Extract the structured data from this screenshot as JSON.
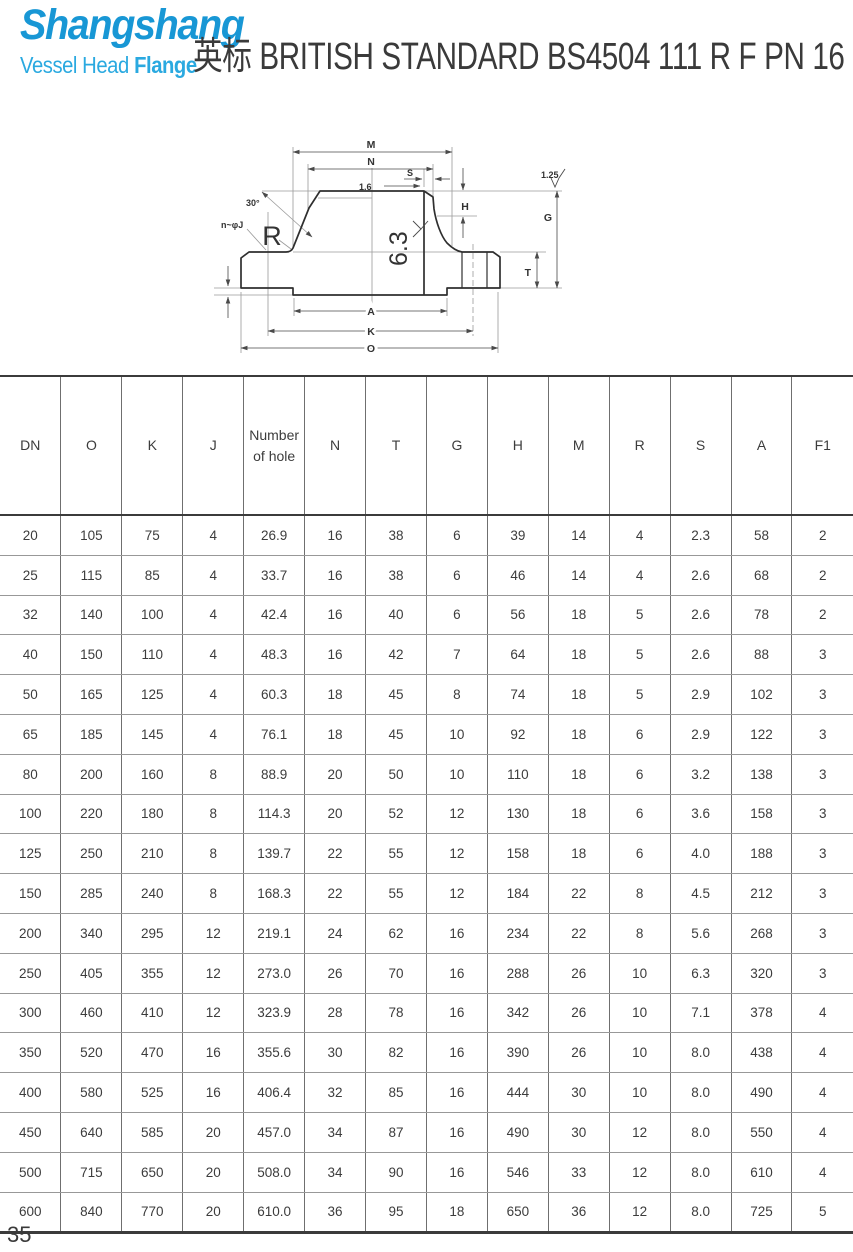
{
  "logo": {
    "brand": "Shangshang",
    "sub1": "Vessel Head",
    "sub2": "Flange",
    "brand_color": "#1897d5",
    "sub_color": "#2aa9e0"
  },
  "header": {
    "title": "英标 BRITISH STANDARD BS4504 111 R F PN 16"
  },
  "drawing": {
    "labels": {
      "m": "M",
      "n": "N",
      "s": "S",
      "chamfer": "1.6",
      "h": "H",
      "g": "G",
      "t": "T",
      "a": "A",
      "k": "K",
      "o": "O",
      "radius": "R",
      "angle": "30°",
      "holes": "n~φJ",
      "roughness_bore": "6.3",
      "roughness_face": "1.25"
    }
  },
  "table": {
    "columns": [
      "DN",
      "O",
      "K",
      "J",
      "Number of hole",
      "N",
      "T",
      "G",
      "H",
      "M",
      "R",
      "S",
      "A",
      "F1"
    ],
    "rows": [
      [
        "20",
        "105",
        "75",
        "4",
        "26.9",
        "16",
        "38",
        "6",
        "39",
        "14",
        "4",
        "2.3",
        "58",
        "2"
      ],
      [
        "25",
        "115",
        "85",
        "4",
        "33.7",
        "16",
        "38",
        "6",
        "46",
        "14",
        "4",
        "2.6",
        "68",
        "2"
      ],
      [
        "32",
        "140",
        "100",
        "4",
        "42.4",
        "16",
        "40",
        "6",
        "56",
        "18",
        "5",
        "2.6",
        "78",
        "2"
      ],
      [
        "40",
        "150",
        "110",
        "4",
        "48.3",
        "16",
        "42",
        "7",
        "64",
        "18",
        "5",
        "2.6",
        "88",
        "3"
      ],
      [
        "50",
        "165",
        "125",
        "4",
        "60.3",
        "18",
        "45",
        "8",
        "74",
        "18",
        "5",
        "2.9",
        "102",
        "3"
      ],
      [
        "65",
        "185",
        "145",
        "4",
        "76.1",
        "18",
        "45",
        "10",
        "92",
        "18",
        "6",
        "2.9",
        "122",
        "3"
      ],
      [
        "80",
        "200",
        "160",
        "8",
        "88.9",
        "20",
        "50",
        "10",
        "110",
        "18",
        "6",
        "3.2",
        "138",
        "3"
      ],
      [
        "100",
        "220",
        "180",
        "8",
        "114.3",
        "20",
        "52",
        "12",
        "130",
        "18",
        "6",
        "3.6",
        "158",
        "3"
      ],
      [
        "125",
        "250",
        "210",
        "8",
        "139.7",
        "22",
        "55",
        "12",
        "158",
        "18",
        "6",
        "4.0",
        "188",
        "3"
      ],
      [
        "150",
        "285",
        "240",
        "8",
        "168.3",
        "22",
        "55",
        "12",
        "184",
        "22",
        "8",
        "4.5",
        "212",
        "3"
      ],
      [
        "200",
        "340",
        "295",
        "12",
        "219.1",
        "24",
        "62",
        "16",
        "234",
        "22",
        "8",
        "5.6",
        "268",
        "3"
      ],
      [
        "250",
        "405",
        "355",
        "12",
        "273.0",
        "26",
        "70",
        "16",
        "288",
        "26",
        "10",
        "6.3",
        "320",
        "3"
      ],
      [
        "300",
        "460",
        "410",
        "12",
        "323.9",
        "28",
        "78",
        "16",
        "342",
        "26",
        "10",
        "7.1",
        "378",
        "4"
      ],
      [
        "350",
        "520",
        "470",
        "16",
        "355.6",
        "30",
        "82",
        "16",
        "390",
        "26",
        "10",
        "8.0",
        "438",
        "4"
      ],
      [
        "400",
        "580",
        "525",
        "16",
        "406.4",
        "32",
        "85",
        "16",
        "444",
        "30",
        "10",
        "8.0",
        "490",
        "4"
      ],
      [
        "450",
        "640",
        "585",
        "20",
        "457.0",
        "34",
        "87",
        "16",
        "490",
        "30",
        "12",
        "8.0",
        "550",
        "4"
      ],
      [
        "500",
        "715",
        "650",
        "20",
        "508.0",
        "34",
        "90",
        "16",
        "546",
        "33",
        "12",
        "8.0",
        "610",
        "4"
      ],
      [
        "600",
        "840",
        "770",
        "20",
        "610.0",
        "36",
        "95",
        "18",
        "650",
        "36",
        "12",
        "8.0",
        "725",
        "5"
      ]
    ]
  },
  "footer": {
    "page_number": "35"
  }
}
